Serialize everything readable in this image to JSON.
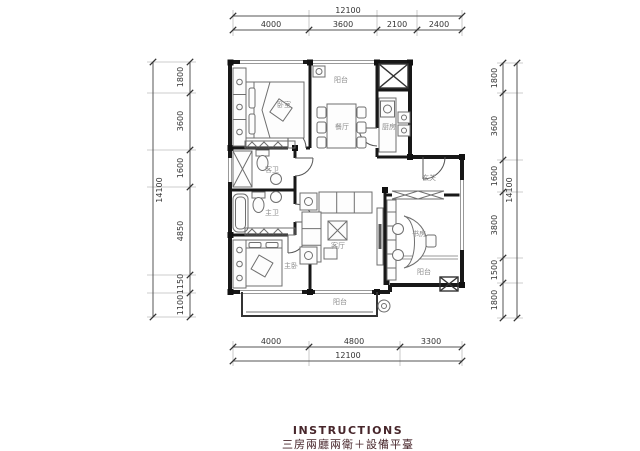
{
  "title": {
    "heading": "INSTRUCTIONS",
    "subheading": "三房兩廳兩衛＋設備平臺"
  },
  "dims": {
    "top": {
      "total": "12100",
      "segments": [
        "4000",
        "3600",
        "2100",
        "2400"
      ]
    },
    "bottom": {
      "total": "12100",
      "segments": [
        "4000",
        "4800",
        "3300"
      ]
    },
    "left": {
      "total": "14100",
      "segments": [
        "1800",
        "3600",
        "1600",
        "4850",
        "1150",
        "1100"
      ]
    },
    "right": {
      "total": "14100",
      "segments": [
        "1800",
        "3600",
        "1600",
        "3800",
        "1500",
        "1800"
      ]
    }
  },
  "rooms": {
    "bedroom": "卧室",
    "balcony_top": "阳台",
    "dining": "餐厅",
    "kitchen": "厨房",
    "foyer": "玄关",
    "study": "书房",
    "living": "客厅",
    "guest_bath": "客卫",
    "master_bath": "主卫",
    "master_bedroom": "主卧",
    "balcony_bottom": "阳台",
    "balcony_right": "阳台"
  },
  "colors": {
    "wall": "#181818",
    "dimension_text": "#333333",
    "room_text": "#8c8c8c",
    "title_text": "#47262b"
  }
}
